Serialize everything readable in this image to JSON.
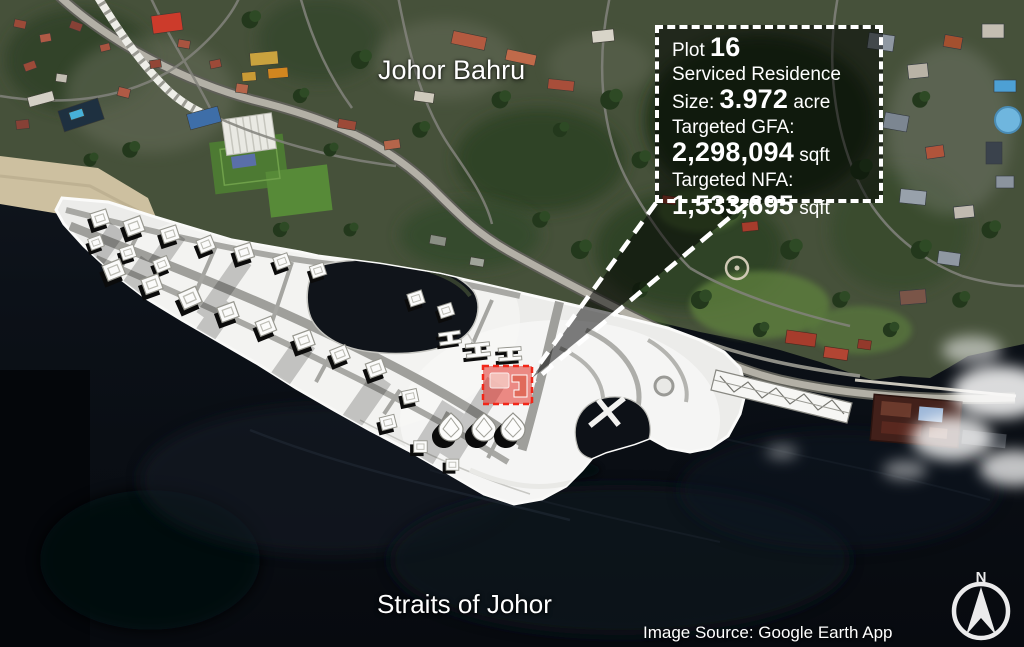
{
  "labels": {
    "city": "Johor Bahru",
    "water_body": "Straits of Johor",
    "credit": "Image Source: Google Earth App",
    "compass_north": "N"
  },
  "callout": {
    "plot_label": "Plot ",
    "plot_number": "16",
    "use_type": "Serviced Residence",
    "size_label": "Size: ",
    "size_value": "3.972",
    "size_unit": " acre",
    "gfa_label": "Targeted GFA:",
    "gfa_value": "2,298,094",
    "gfa_unit": " sqft",
    "nfa_label": "Targeted NFA:",
    "nfa_value": "1,533,695",
    "nfa_unit": " sqft"
  },
  "colors": {
    "plot_highlight_stroke": "#f22718",
    "plot_highlight_fill": "rgba(226,48,38,0.55)",
    "callout_border": "#ffffff",
    "water": "#0a0e14"
  }
}
